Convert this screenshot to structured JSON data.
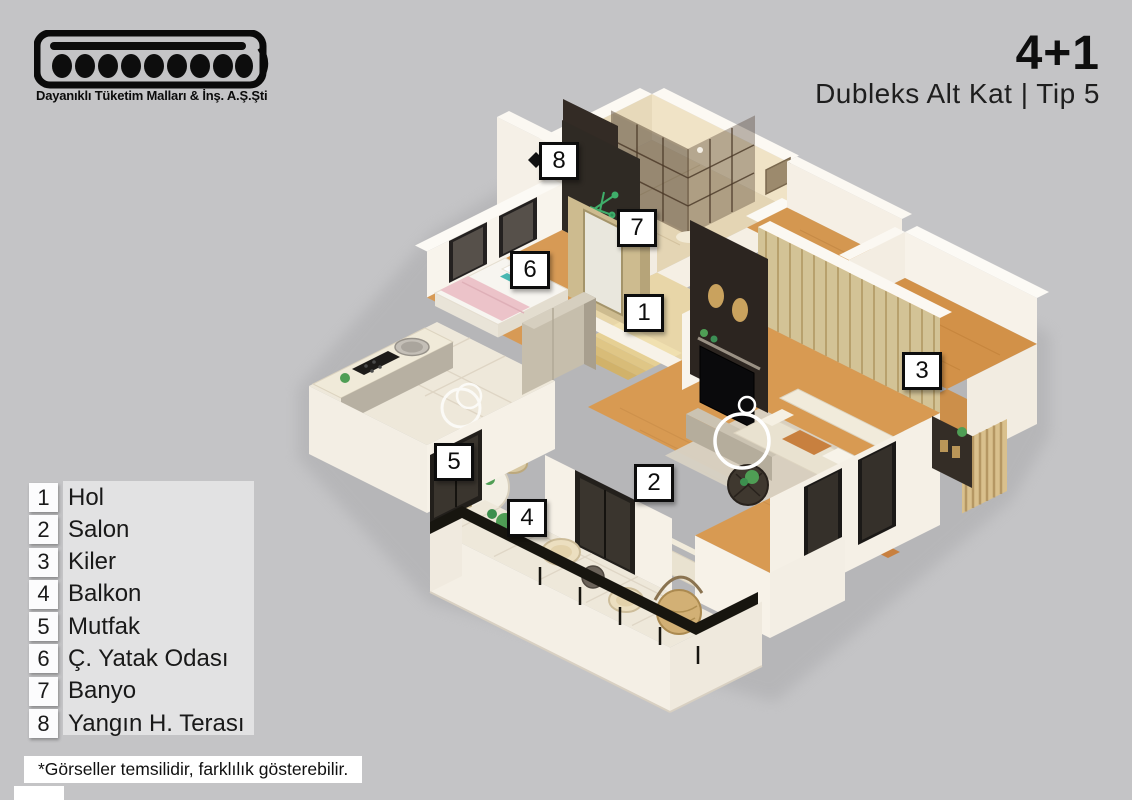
{
  "header": {
    "logo_tagline": "Dayanıklı Tüketim Malları & İnş. A.Ş.Şti",
    "plan_type": "4+1",
    "plan_subtitle": "Dubleks Alt Kat | Tip 5"
  },
  "legend": {
    "items": [
      {
        "num": "1",
        "label": "Hol"
      },
      {
        "num": "2",
        "label": "Salon"
      },
      {
        "num": "3",
        "label": "Kiler"
      },
      {
        "num": "4",
        "label": "Balkon"
      },
      {
        "num": "5",
        "label": "Mutfak"
      },
      {
        "num": "6",
        "label": "Ç. Yatak Odası"
      },
      {
        "num": "7",
        "label": "Banyo"
      },
      {
        "num": "8",
        "label": "Yangın H. Terası"
      }
    ]
  },
  "floorplan": {
    "markers": [
      {
        "num": "1",
        "room": "Hol",
        "x": 644,
        "y": 313
      },
      {
        "num": "2",
        "room": "Salon",
        "x": 654,
        "y": 483
      },
      {
        "num": "3",
        "room": "Kiler",
        "x": 922,
        "y": 371
      },
      {
        "num": "4",
        "room": "Balkon",
        "x": 527,
        "y": 518
      },
      {
        "num": "5",
        "room": "Mutfak",
        "x": 454,
        "y": 462
      },
      {
        "num": "6",
        "room": "Ç. Yatak Odası",
        "x": 530,
        "y": 270
      },
      {
        "num": "7",
        "room": "Banyo",
        "x": 637,
        "y": 228
      },
      {
        "num": "8",
        "room": "Yangın H. Terası",
        "x": 559,
        "y": 161
      }
    ]
  },
  "footer": {
    "disclaimer": "*Görseller temsilidir, farklılık gösterebilir."
  },
  "colors": {
    "background": "#c4c4c6",
    "wall_white": "#f7f2e9",
    "wood_floor": "#d89a52",
    "tile_floor": "#eee8da",
    "dark_accent": "#2c2520",
    "badge_border": "#0d0d0d"
  }
}
